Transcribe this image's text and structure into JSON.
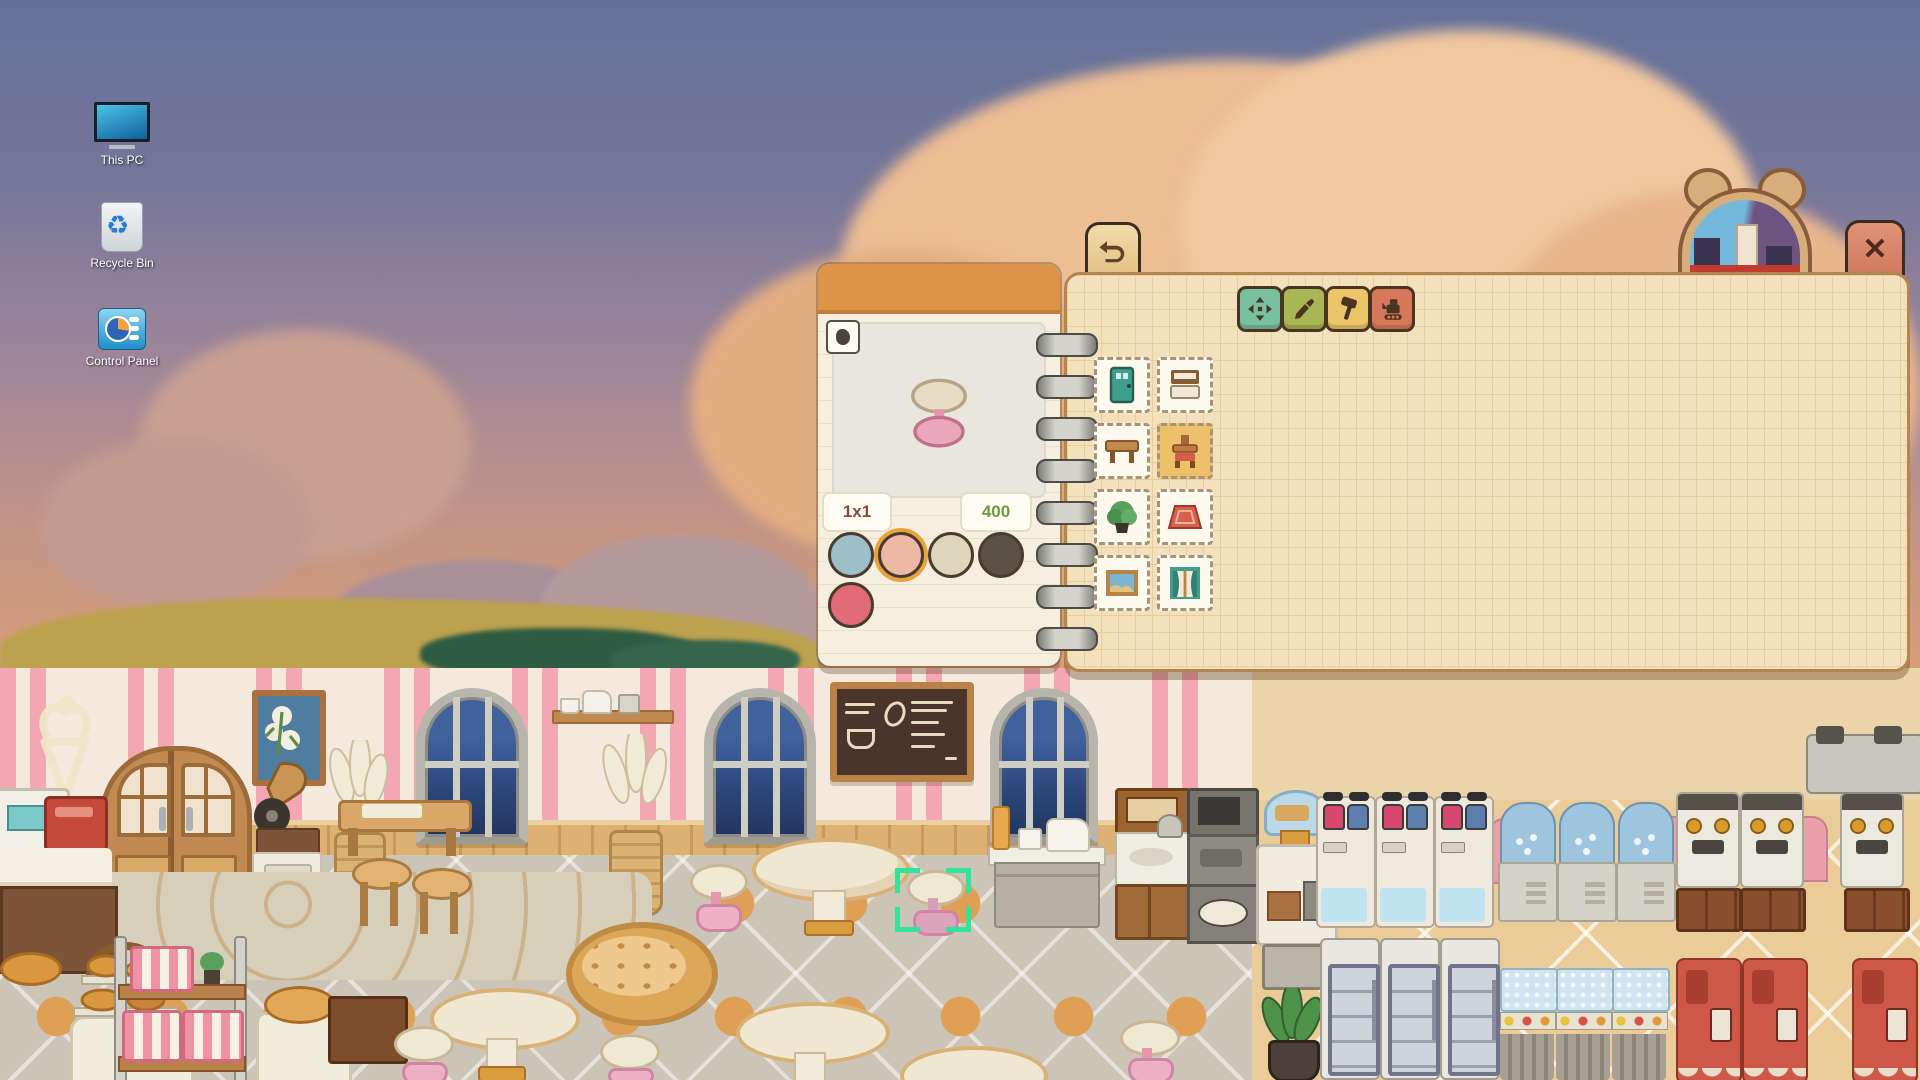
{
  "desktop": {
    "icons": [
      {
        "label": "This PC"
      },
      {
        "label": "Recycle Bin"
      },
      {
        "label": "Control Panel"
      }
    ]
  },
  "hud": {
    "money": "6362648",
    "help": "?",
    "close": "✕"
  },
  "toolbar": {
    "tools": [
      "move",
      "eyedropper",
      "hammer",
      "demolish"
    ]
  },
  "notebook": {
    "category_title": "Chair",
    "categories": [
      "door",
      "bed",
      "table",
      "chair",
      "plant",
      "rug",
      "painting",
      "window"
    ],
    "selected_category": "chair",
    "grid": {
      "top_row_prices": [
        "250",
        "300",
        "300",
        "400",
        "400"
      ],
      "mid_row": [
        {
          "item": "cream chair",
          "price": "400"
        },
        {
          "item": "pink stool",
          "price": "400",
          "selected": true
        },
        {
          "item": "angular chair",
          "price": "500"
        },
        {
          "item": "mushroom stool",
          "price": "500"
        },
        {
          "item": "red armchair",
          "price": "600"
        }
      ],
      "bottom_row": [
        {
          "item": "deck chair"
        },
        {
          "item": "blue armchair"
        },
        {
          "item": "cream lounge chair"
        }
      ]
    }
  },
  "preview": {
    "size": "1x1",
    "price": "400",
    "swatches": [
      "#9dbfca",
      "#edb9a4",
      "#ddd6bc",
      "#5c5147",
      "#e26b78"
    ],
    "selected_swatch_index": 1
  },
  "colors": {
    "accent_orange": "#dd9448",
    "price_green": "#76a33e",
    "selection_green": "#2fe59b",
    "panel_cream": "#f6efdf"
  }
}
